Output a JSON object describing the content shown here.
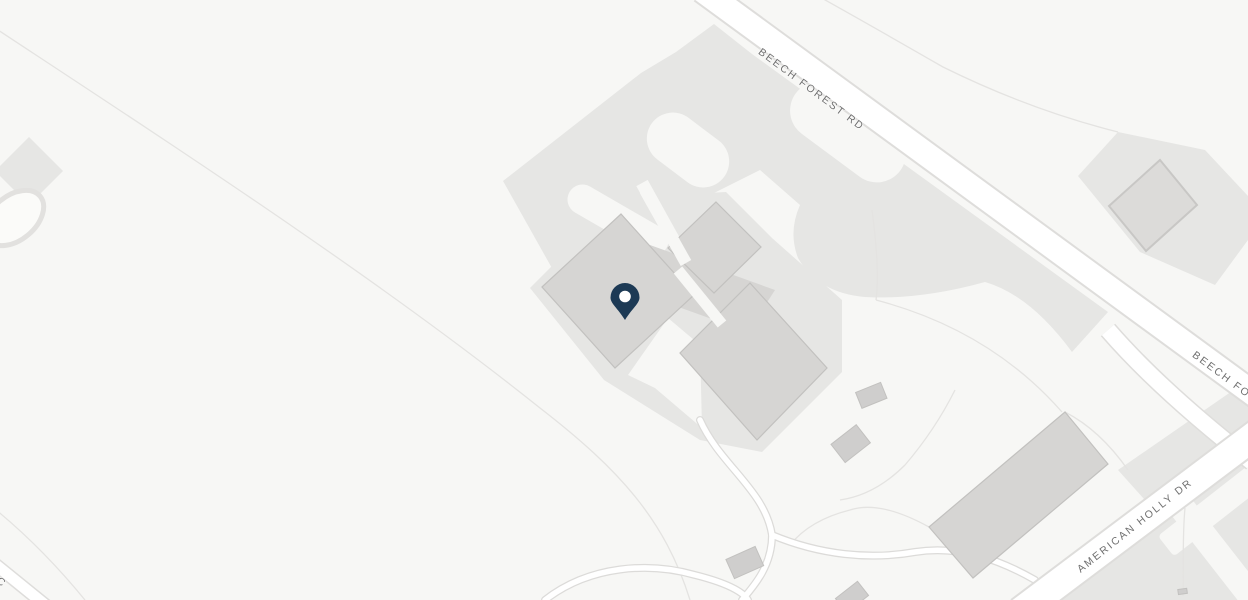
{
  "map": {
    "type": "street-map-view",
    "labels": {
      "beech_forest_rd": "BEECH FOREST RD",
      "beech_forest_rd_partial": "BEECH FOREST RD",
      "american_holly_dr": "AMERICAN HOLLY DR",
      "left_edge_partial": "RIC"
    },
    "marker": {
      "name": "location-pin",
      "color": "#1d3a55",
      "inner_dot_color": "#ffffff"
    },
    "colors": {
      "bg": "#f7f7f5",
      "road_fill": "#ffffff",
      "road_casing": "#dedddb",
      "lot_fill": "#e6e6e4",
      "building_fill": "#d6d5d3",
      "building_stroke": "#c2c1bf",
      "building_dark": "#cfcecd",
      "faint_line": "#e4e3e1",
      "path_casing": "#dcdbd9",
      "label_color": "#6f6f6f",
      "pin_color": "#1d3a55",
      "pin_inner": "#ffffff"
    }
  }
}
